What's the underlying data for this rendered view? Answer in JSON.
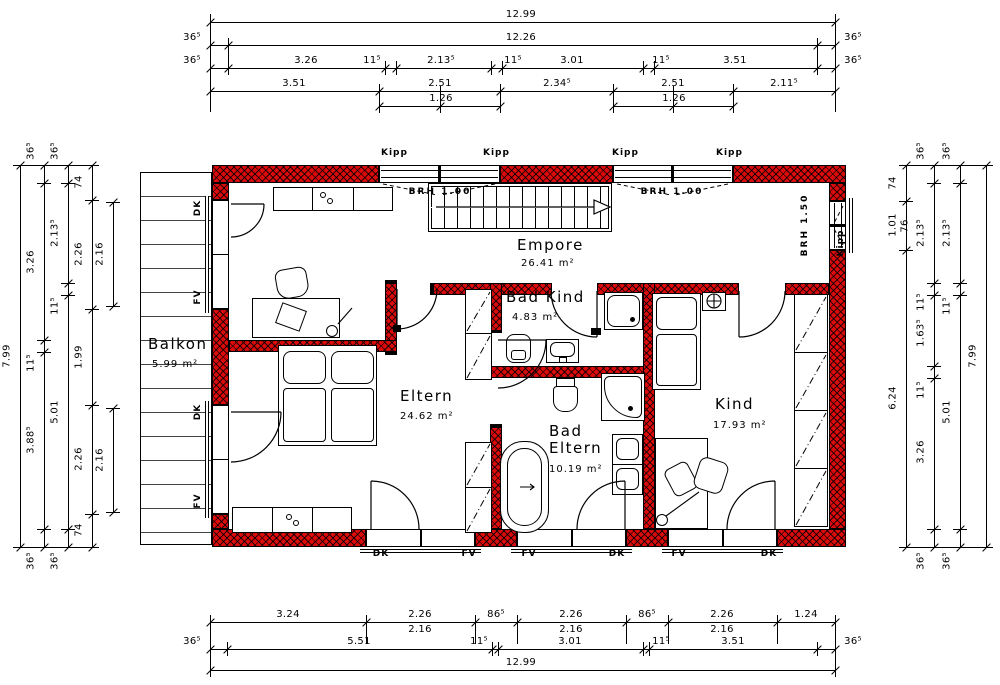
{
  "drawing": {
    "wall_color": "#db0b0b",
    "rooms": [
      {
        "name": "Balkon",
        "area": "5.99 m²",
        "nx": 148,
        "ny": 336,
        "ax": 152,
        "ay": 359
      },
      {
        "name": "Empore",
        "area": "26.41 m²",
        "nx": 517,
        "ny": 237,
        "ax": 521,
        "ay": 258
      },
      {
        "name": "Eltern",
        "area": "24.62 m²",
        "nx": 400,
        "ny": 388,
        "ax": 400,
        "ay": 411
      },
      {
        "name": "Bad Kind",
        "area": "4.83 m²",
        "nx": 506,
        "ny": 289,
        "ax": 512,
        "ay": 312
      },
      {
        "name": "Bad\nEltern",
        "area": "10.19 m²",
        "nx": 549,
        "ny": 423,
        "ax": 549,
        "ay": 464
      },
      {
        "name": "Kind",
        "area": "17.93 m²",
        "nx": 715,
        "ny": 396,
        "ax": 713,
        "ay": 420
      }
    ],
    "window_tags": [
      {
        "t": "Kipp",
        "x": 381,
        "y": 149
      },
      {
        "t": "Kipp",
        "x": 483,
        "y": 149
      },
      {
        "t": "Kipp",
        "x": 612,
        "y": 149
      },
      {
        "t": "Kipp",
        "x": 716,
        "y": 149
      },
      {
        "t": "Kipp",
        "x": 842,
        "y": 243,
        "rot": -90
      }
    ],
    "sill_tags": [
      {
        "t": "BRH 1.00",
        "cx": 440,
        "y": 188
      },
      {
        "t": "BRH 1.00",
        "cx": 672,
        "y": 188
      },
      {
        "t": "BRH 1.50",
        "x": 806,
        "y": 225,
        "rot": -90
      }
    ],
    "door_tags": [
      {
        "t": "DK",
        "x": 199,
        "y": 208,
        "rot": -90
      },
      {
        "t": "FV",
        "x": 199,
        "y": 297,
        "rot": -90
      },
      {
        "t": "DK",
        "x": 199,
        "y": 412,
        "rot": -90
      },
      {
        "t": "FV",
        "x": 199,
        "y": 501,
        "rot": -90
      },
      {
        "t": "DK",
        "cx": 381,
        "y": 550
      },
      {
        "t": "FV",
        "cx": 469,
        "y": 550
      },
      {
        "t": "FV",
        "cx": 529,
        "y": 550
      },
      {
        "t": "DK",
        "cx": 617,
        "y": 550
      },
      {
        "t": "FV",
        "cx": 679,
        "y": 550
      },
      {
        "t": "DK",
        "cx": 769,
        "y": 550
      }
    ]
  },
  "dimensions": {
    "horizontal_rows": [
      {
        "y": 22,
        "x1": 210,
        "x2": 835,
        "ticks": [
          210,
          835
        ],
        "labels": [
          {
            "t": "12.99",
            "c": 521
          }
        ]
      },
      {
        "y": 45,
        "x1": 210,
        "x2": 835,
        "ticks": [
          210,
          228,
          817,
          835
        ],
        "labels": [
          {
            "t": "36⁵",
            "c": 192
          },
          {
            "t": "12.26",
            "c": 521
          },
          {
            "t": "36⁵",
            "c": 853
          }
        ]
      },
      {
        "y": 68,
        "x1": 210,
        "x2": 835,
        "ticks": [
          210,
          228,
          385,
          396,
          491,
          502,
          643,
          654,
          817,
          835
        ],
        "labels": [
          {
            "t": "36⁵",
            "c": 192
          },
          {
            "t": "3.26",
            "c": 306
          },
          {
            "t": "11⁵",
            "c": 372
          },
          {
            "t": "2.13⁵",
            "c": 441
          },
          {
            "t": "11⁵",
            "c": 513
          },
          {
            "t": "3.01",
            "c": 572
          },
          {
            "t": "11⁵",
            "c": 661
          },
          {
            "t": "3.51",
            "c": 735
          },
          {
            "t": "36⁵",
            "c": 853
          }
        ]
      },
      {
        "y": 91,
        "x1": 210,
        "x2": 835,
        "ticks": [
          210,
          379,
          500,
          613,
          733,
          835
        ],
        "labels": [
          {
            "t": "3.51",
            "c": 294
          },
          {
            "t": "2.51",
            "c": 440
          },
          {
            "t": "2.34⁵",
            "c": 557
          },
          {
            "t": "2.51",
            "c": 673
          },
          {
            "t": "2.11⁵",
            "c": 784
          }
        ]
      },
      {
        "y": 106,
        "x1": 379,
        "x2": 500,
        "ticks": [
          379,
          440,
          500
        ],
        "labels": [
          {
            "t": "1.26",
            "c": 441
          }
        ]
      },
      {
        "y": 106,
        "x1": 613,
        "x2": 733,
        "ticks": [
          613,
          673,
          733
        ],
        "labels": [
          {
            "t": "1.26",
            "c": 674
          }
        ]
      },
      {
        "y": 622,
        "x1": 210,
        "x2": 835,
        "ticks": [
          210,
          366,
          475,
          517,
          626,
          668,
          777,
          835
        ],
        "labels": [
          {
            "t": "3.24",
            "c": 288
          },
          {
            "t": "2.26",
            "c": 420
          },
          {
            "t": "86⁵",
            "c": 496
          },
          {
            "t": "2.26",
            "c": 571
          },
          {
            "t": "86⁵",
            "c": 647
          },
          {
            "t": "2.26",
            "c": 722
          },
          {
            "t": "1.24",
            "c": 806
          }
        ]
      },
      {
        "y": 637,
        "no_line": true,
        "labels": [
          {
            "t": "2.16",
            "c": 420
          },
          {
            "t": "2.16",
            "c": 571
          },
          {
            "t": "2.16",
            "c": 722
          }
        ]
      },
      {
        "y": 649,
        "x1": 210,
        "x2": 835,
        "ticks": [
          210,
          227,
          492,
          498,
          643,
          649,
          817,
          835
        ],
        "labels": [
          {
            "t": "36⁵",
            "c": 192
          },
          {
            "t": "5.51",
            "c": 359
          },
          {
            "t": "11⁵",
            "c": 479
          },
          {
            "t": "3.01",
            "c": 570
          },
          {
            "t": "11⁵",
            "c": 661
          },
          {
            "t": "3.51",
            "c": 733
          },
          {
            "t": "36⁵",
            "c": 853
          }
        ]
      },
      {
        "y": 670,
        "x1": 210,
        "x2": 835,
        "ticks": [
          210,
          835
        ],
        "labels": [
          {
            "t": "12.99",
            "c": 521
          }
        ]
      }
    ],
    "vertical_cols": [
      {
        "x": 20,
        "ticks": [
          165,
          547
        ],
        "labels": [
          {
            "t": "7.99",
            "c": 356
          }
        ]
      },
      {
        "x": 44,
        "ticks": [
          165,
          183,
          340,
          352,
          529,
          547
        ],
        "labels": [
          {
            "t": "36⁵",
            "c": 151
          },
          {
            "t": "3.26",
            "c": 262
          },
          {
            "t": "11⁵",
            "c": 363
          },
          {
            "t": "3.88⁵",
            "c": 440
          },
          {
            "t": "36⁵",
            "c": 561
          }
        ]
      },
      {
        "x": 68,
        "ticks": [
          165,
          183,
          283,
          295,
          529,
          547
        ],
        "labels": [
          {
            "t": "36⁵",
            "c": 151
          },
          {
            "t": "2.13⁵",
            "c": 233
          },
          {
            "t": "11⁵",
            "c": 306
          },
          {
            "t": "5.01",
            "c": 412
          },
          {
            "t": "36⁵",
            "c": 561
          }
        ]
      },
      {
        "x": 92,
        "ticks": [
          165,
          200,
          309,
          405,
          514,
          547
        ],
        "labels": [
          {
            "t": "74",
            "c": 182
          },
          {
            "t": "2.26",
            "c": 254
          },
          {
            "t": "1.99",
            "c": 357
          },
          {
            "t": "2.26",
            "c": 459
          },
          {
            "t": "74",
            "c": 530
          }
        ]
      },
      {
        "x": 113,
        "ticks": [
          202,
          306
        ],
        "labels": [
          {
            "t": "2.16",
            "c": 254
          }
        ]
      },
      {
        "x": 113,
        "ticks": [
          408,
          512
        ],
        "labels": [
          {
            "t": "2.16",
            "c": 460
          }
        ]
      },
      {
        "x": 906,
        "ticks": [
          165,
          201,
          250,
          547
        ],
        "labels": [
          {
            "t": "74",
            "c": 183
          },
          {
            "t": "1.01",
            "c": 225
          },
          {
            "t": "6.24",
            "c": 398
          }
        ]
      },
      {
        "x": 918,
        "no_line": true,
        "labels": [
          {
            "t": "76",
            "c": 226
          }
        ]
      },
      {
        "x": 934,
        "ticks": [
          165,
          183,
          283,
          295,
          366,
          378,
          529,
          547
        ],
        "labels": [
          {
            "t": "36⁵",
            "c": 151
          },
          {
            "t": "2.13⁵",
            "c": 233
          },
          {
            "t": "11⁵",
            "c": 302
          },
          {
            "t": "1.63⁵",
            "c": 333
          },
          {
            "t": "11⁵",
            "c": 390
          },
          {
            "t": "3.26",
            "c": 452
          },
          {
            "t": "36⁵",
            "c": 561
          }
        ]
      },
      {
        "x": 960,
        "ticks": [
          165,
          183,
          283,
          295,
          529,
          547
        ],
        "labels": [
          {
            "t": "36⁵",
            "c": 151
          },
          {
            "t": "2.13⁵",
            "c": 233
          },
          {
            "t": "11⁵",
            "c": 306
          },
          {
            "t": "5.01",
            "c": 412
          },
          {
            "t": "36⁵",
            "c": 561
          }
        ]
      },
      {
        "x": 986,
        "ticks": [
          165,
          547
        ],
        "labels": [
          {
            "t": "7.99",
            "c": 356
          }
        ]
      }
    ],
    "witness_v": [
      {
        "x": 210,
        "y1": 14,
        "y2": 112
      },
      {
        "x": 835,
        "y1": 14,
        "y2": 112
      },
      {
        "x": 228,
        "y1": 40,
        "y2": 74
      },
      {
        "x": 817,
        "y1": 40,
        "y2": 74
      },
      {
        "x": 379,
        "y1": 86,
        "y2": 112
      },
      {
        "x": 440,
        "y1": 86,
        "y2": 112
      },
      {
        "x": 500,
        "y1": 86,
        "y2": 112
      },
      {
        "x": 613,
        "y1": 86,
        "y2": 112
      },
      {
        "x": 673,
        "y1": 86,
        "y2": 112
      },
      {
        "x": 733,
        "y1": 86,
        "y2": 112
      },
      {
        "x": 210,
        "y1": 616,
        "y2": 676
      },
      {
        "x": 835,
        "y1": 616,
        "y2": 676
      },
      {
        "x": 366,
        "y1": 616,
        "y2": 644
      },
      {
        "x": 475,
        "y1": 616,
        "y2": 644
      },
      {
        "x": 517,
        "y1": 616,
        "y2": 644
      },
      {
        "x": 626,
        "y1": 616,
        "y2": 644
      },
      {
        "x": 668,
        "y1": 616,
        "y2": 644
      },
      {
        "x": 777,
        "y1": 616,
        "y2": 644
      }
    ],
    "witness_h": [
      {
        "y": 165,
        "x1": 14,
        "x2": 98
      },
      {
        "y": 547,
        "x1": 14,
        "x2": 98
      },
      {
        "y": 165,
        "x1": 900,
        "x2": 992
      },
      {
        "y": 547,
        "x1": 900,
        "x2": 992
      }
    ]
  }
}
